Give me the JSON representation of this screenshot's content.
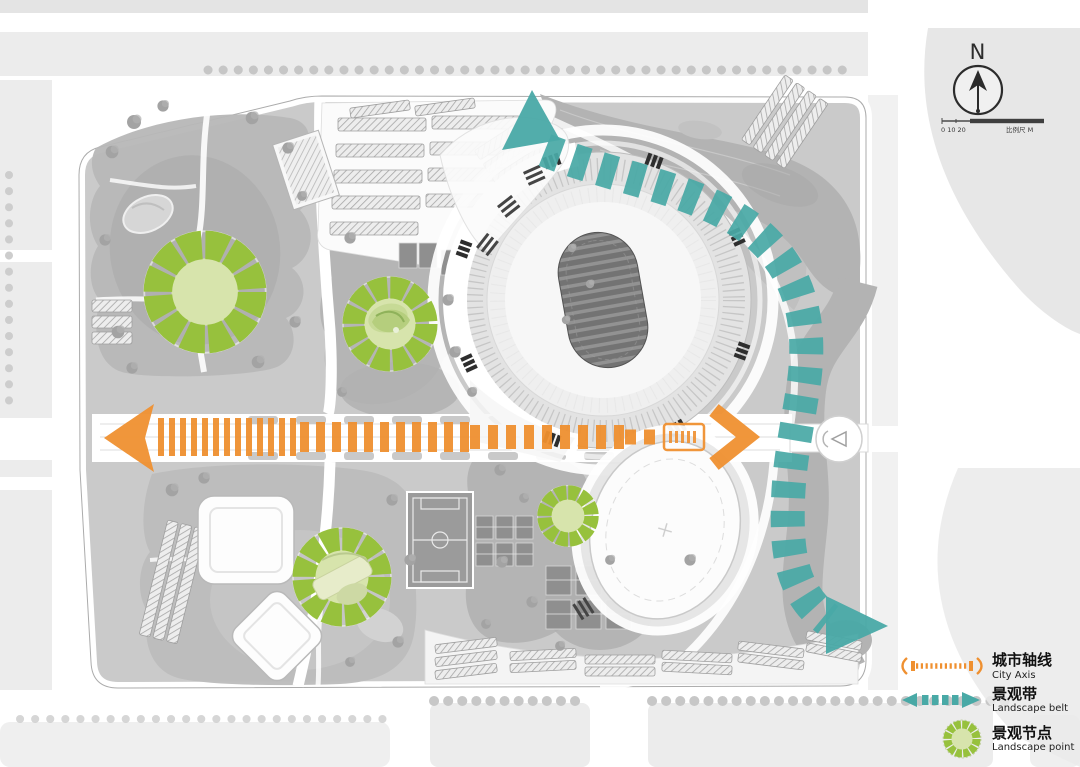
{
  "colors": {
    "city_axis": "#EF9030",
    "landscape_belt": "#49A9A6",
    "point_ring": "#97C13D",
    "point_center": "#D7E4AC",
    "river": "#B3B3B3",
    "ground": "#CACACA",
    "park": "#B7B7B7",
    "court": "#8F8F8F",
    "block": "#ECECEC",
    "road": "#FFFFFF"
  },
  "north": {
    "label": "N"
  },
  "scale_bar": {
    "left_ticks": "0 10 20",
    "right_label": "比例尺 M"
  },
  "legend": {
    "items": [
      {
        "id": "city-axis",
        "zh": "城市轴线",
        "en": "City Axis"
      },
      {
        "id": "landscape-belt",
        "zh": "景观带",
        "en": "Landscape belt"
      },
      {
        "id": "landscape-point",
        "zh": "景观节点",
        "en": "Landscape point"
      }
    ]
  },
  "plan_overlays": {
    "city_axis": {
      "y": 437,
      "arrow_left": [
        [
          104,
          438
        ],
        [
          154,
          404
        ],
        [
          145,
          438
        ],
        [
          154,
          472
        ]
      ],
      "segments": [
        {
          "x1": 158,
          "x2": 300,
          "h": 38,
          "dash": "6 5"
        },
        {
          "x1": 300,
          "x2": 470,
          "h": 30,
          "dash": "9 7"
        },
        {
          "x1": 470,
          "x2": 625,
          "h": 24,
          "dash": "10 8"
        },
        {
          "x1": 625,
          "x2": 662,
          "h": 15,
          "dash": "11 8"
        }
      ],
      "station_box": {
        "x": 664,
        "y": 424,
        "w": 40,
        "h": 26
      },
      "arrow_right": {
        "points": [
          [
            714,
            410
          ],
          [
            748,
            437
          ],
          [
            714,
            464
          ]
        ],
        "width": 15
      }
    },
    "landscape_belt": {
      "path": "M 545,150 C 620,180 700,188 755,232 C 800,270 812,322 804,382 C 795,442 786,472 788,532 C 790,577 804,602 828,620",
      "width": 34,
      "dash": "16 13",
      "start_arrow": [
        [
          532,
          90
        ],
        [
          502,
          150
        ],
        [
          560,
          140
        ]
      ],
      "end_arrow": [
        [
          826,
          596
        ],
        [
          888,
          626
        ],
        [
          826,
          654
        ]
      ]
    },
    "landscape_points": [
      {
        "cx": 205,
        "cy": 292,
        "d": 124
      },
      {
        "cx": 390,
        "cy": 324,
        "d": 96
      },
      {
        "cx": 342,
        "cy": 577,
        "d": 100
      },
      {
        "cx": 568,
        "cy": 516,
        "d": 62
      }
    ]
  }
}
